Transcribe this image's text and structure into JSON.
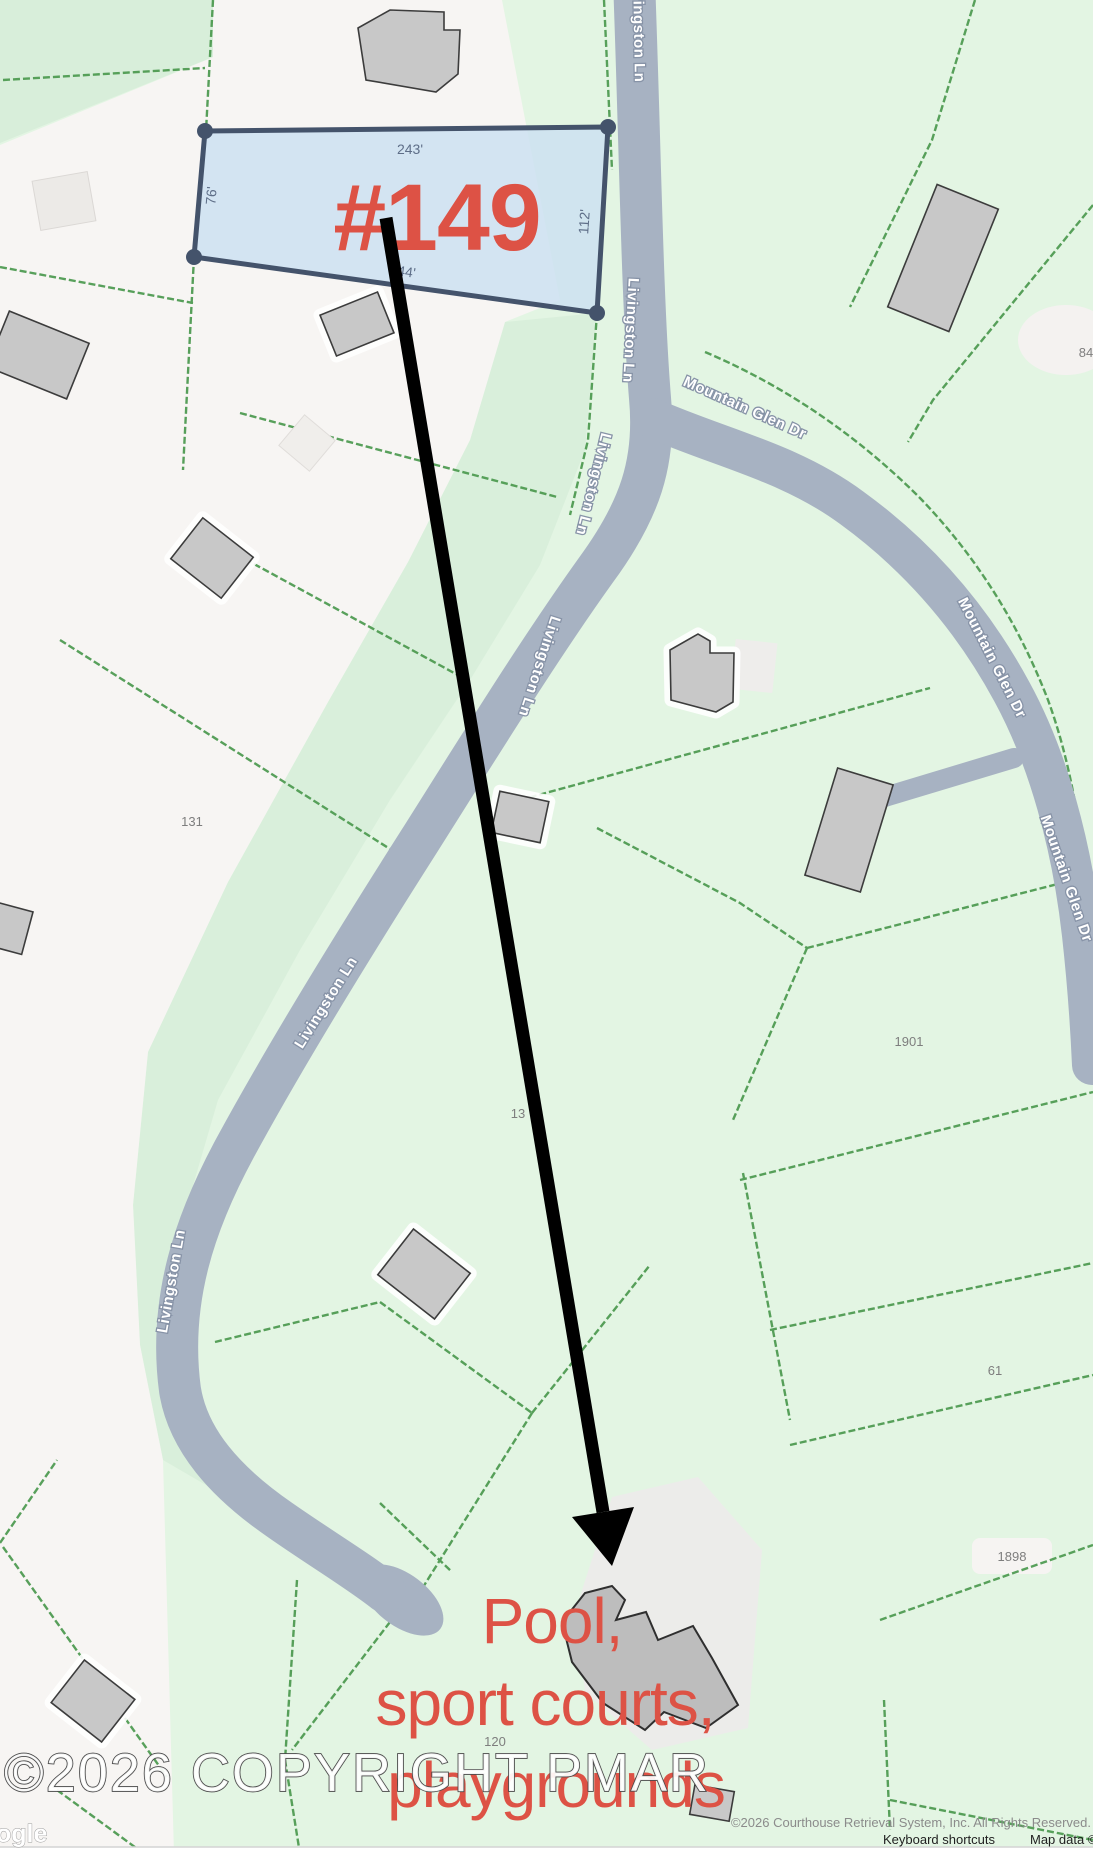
{
  "map": {
    "highlight_parcel": {
      "label": "#149",
      "dim_top": "243'",
      "dim_left": "76'",
      "dim_right": "112'",
      "dim_bottom": "244'"
    },
    "road_labels": {
      "livingston": [
        "Livingston Ln",
        "Livingston Ln",
        "Livingston Ln",
        "Livingston Ln",
        "Livingston Ln",
        "Livingston Ln"
      ],
      "mountain": [
        "Mountain Glen Dr",
        "Mountain Glen Dr",
        "Mountain Glen Dr"
      ]
    },
    "parcel_numbers": {
      "p131": "131",
      "p84": "84",
      "p1901": "1901",
      "p13": "13",
      "p61": "61",
      "p1898": "1898",
      "p120": "120"
    },
    "annotation": {
      "line1": "Pool,",
      "line2": "sport courts,",
      "line3": "playgrounds"
    },
    "watermark": "©2026 COPYRIGHT PMAR",
    "google_logo": "ogle",
    "attribution": {
      "rights": "©2026 Courthouse Retrieval System, Inc. All Rights Reserved.",
      "keyboard": "Keyboard shortcuts",
      "mapdata": "Map data ©2026"
    },
    "colors": {
      "accent_red": "#dd5245",
      "parcel_fill": "#cde0f1",
      "parcel_stroke": "#44536b",
      "road": "#a7b2c2",
      "lot_line": "#4f9b52",
      "green_base": "#e3f5e3",
      "green_dark": "#d9efdb",
      "white_area": "#f7f5f3",
      "arrow": "#000000"
    }
  }
}
